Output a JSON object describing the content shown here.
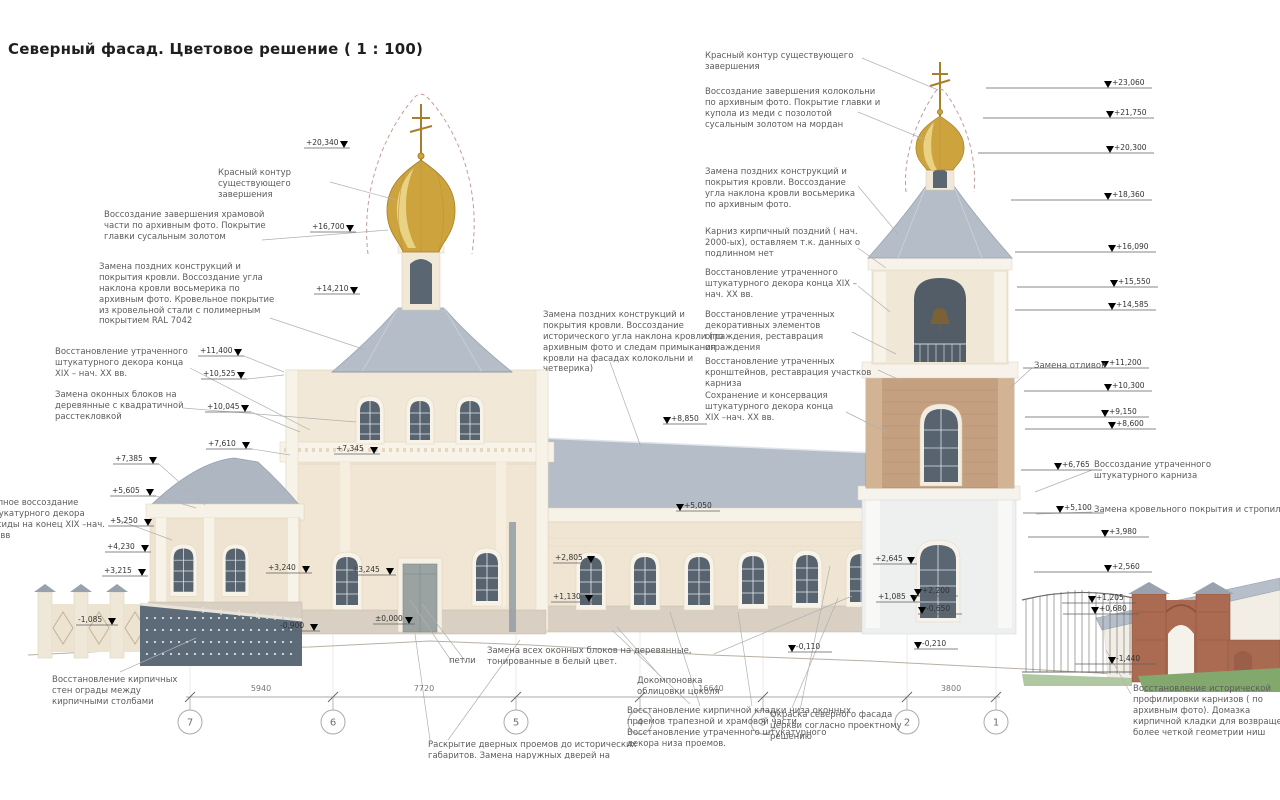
{
  "title": "Северный фасад. Цветовое решение ( 1 : 100)",
  "ann": {
    "left_contour": "Красный контур существующего завершения",
    "dome_restore": "Воссоздание завершения храмовой части по архивным фото. Покрытие главки сусальным золотом",
    "roof_replace_left": "Замена поздних конструкций и покрытия кровли. Воссоздание угла наклона кровли восьмерика по архивным фото. Кровельное покрытие из кровельной стали с полимерным покрытием RAL 7042",
    "stucco_restore_left": "Восстановление утраченного штукатурного декора конца XIX – нач. XX вв.",
    "window_blocks_left": "Замена оконных блоков на деревянные с квадратичной расстекловкой",
    "apse_decor": "Полное воссоздание штукатурного декора апсиды на конец XIX –нач. XX вв",
    "fence_walls": "Восстановление кирпичных стен ограды между кирпичными столбами",
    "all_windows": "Замена всех оконных блоков на деревянные, тонированные в белый цвет.",
    "hinges": "петли",
    "doors": "Раскрытие дверных проемов до исторических габаритов. Замена наружных дверей на",
    "plinth_cladding": "Докомпоновка облицовки цоколя",
    "brick_base": "Восстановление кирпичной кладки низа оконных проемов трапезной и храмовой части. Восстановление утраченного штукатурного декора низа проемов.",
    "paint_facade": "Окраска северного фасада церкви согласно проектному решению",
    "cornice_profile": "Восстановление исторической профилировки карнизов ( по архивным фото). Домазка кирпичной кладки для возвращения более четкой геометрии ниш",
    "roof_center": "Замена поздних конструкций и покрытия кровли. Воссоздание исторического угла наклона кровли (по архивным фото и следам примыкания кровли на фасадах колокольни и четверика)",
    "right_contour": "Красный контур существующего завершения",
    "belltower_dome": "Воссоздание завершения колокольни по архивным фото. Покрытие главки и купола из меди с позолотой сусальным золотом на мордан",
    "roof_replace_right": "Замена поздних конструкций и покрытия кровли. Воссоздание угла наклона кровли восьмерика по архивным фото.",
    "cornice_brick": "Карниз кирпичный поздний ( нач. 2000-ых), оставляем т.к. данных о подлинном нет",
    "stucco_restore_right": "Восстановление утраченного штукатурного декора конца XIX – нач. XX вв.",
    "railing": "Восстановление утраченных декоративных элементов ограждения, реставрация ограждения",
    "brackets": "Восстановление утраченных кронштейнов, реставрация участков карниза",
    "conservation": "Сохранение и консервация штукатурного декора конца XIX –нач. XX вв.",
    "drips": "Замена отливов",
    "cornice_restore": "Воссоздание утраченного штукатурного карниза",
    "roof_right_low": "Замена кровельного покрытия и стропильных конструкций"
  },
  "elev": {
    "left": [
      "+20,340",
      "+16,700",
      "+14,210",
      "+11,400",
      "+10,525",
      "+10,045",
      "+7,610",
      "+7,385",
      "+7,345",
      "+5,605",
      "+5,250",
      "+4,230",
      "+3,215",
      "+3,240",
      "+3,245",
      "-1,085",
      "-0,900",
      "±0,000"
    ],
    "center": [
      "+8,850",
      "+5,050",
      "+2,805",
      "+1,130",
      "+2,645",
      "+1,085",
      "+2,200",
      "-0,650",
      "-0,110",
      "-0,210"
    ],
    "right": [
      "+23,060",
      "+21,750",
      "+20,300",
      "+18,360",
      "+16,090",
      "+15,550",
      "+14,585",
      "+11,200",
      "+10,300",
      "+9,150",
      "+8,600",
      "+6,765",
      "+5,100",
      "+3,980",
      "+2,560",
      "+1,205",
      "+0,680",
      "-1,440"
    ]
  },
  "axes": [
    "7",
    "6",
    "5",
    "4",
    "3",
    "2",
    "1"
  ],
  "dims": [
    "5940",
    "7720",
    "16640",
    "3800"
  ],
  "palette": {
    "wall": "#f1e6d4",
    "roof": "#b5bec8",
    "gold": "#cda33e",
    "brick": "#ab6a52",
    "glass": "#57636f"
  }
}
